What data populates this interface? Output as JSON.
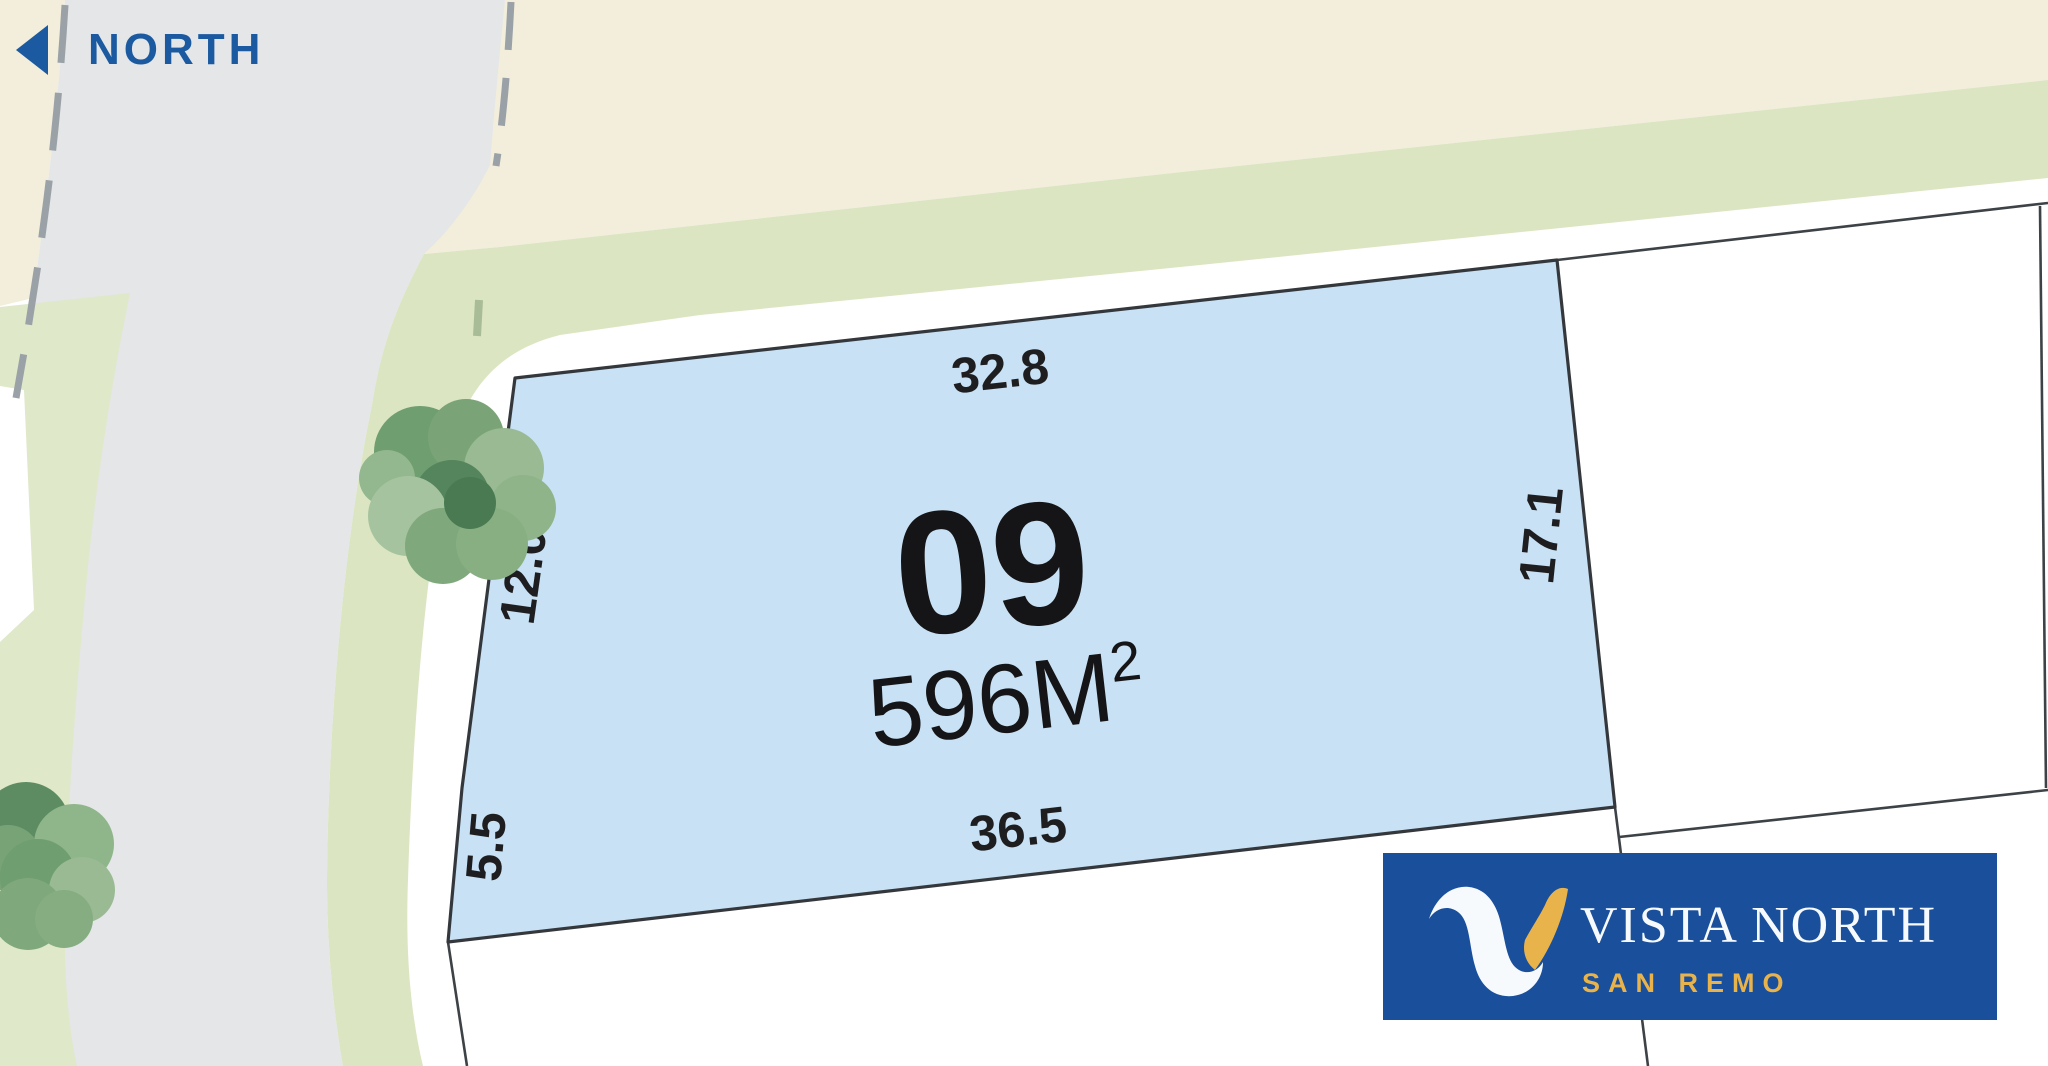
{
  "north_indicator": {
    "label": "NORTH"
  },
  "lot": {
    "number": "09",
    "area_main": "596M",
    "area_superscript": "2",
    "dimensions": {
      "top": "32.8",
      "right": "17.1",
      "bottom": "36.5",
      "left_upper": "12.0",
      "left_lower": "5.5"
    }
  },
  "logo": {
    "title": "VISTA NORTH",
    "subtitle": "SAN REMO"
  },
  "colors": {
    "north_blue": "#1b5aa0",
    "lot_fill": "#c8e1f4",
    "boundary_line": "#3d4246",
    "logo_blue": "#1a4f9c",
    "logo_gold": "#e9b34c",
    "road_gray": "#e4e6e8",
    "reserve_beige": "#f2eedb",
    "verge_green": "#dbe5c1"
  }
}
